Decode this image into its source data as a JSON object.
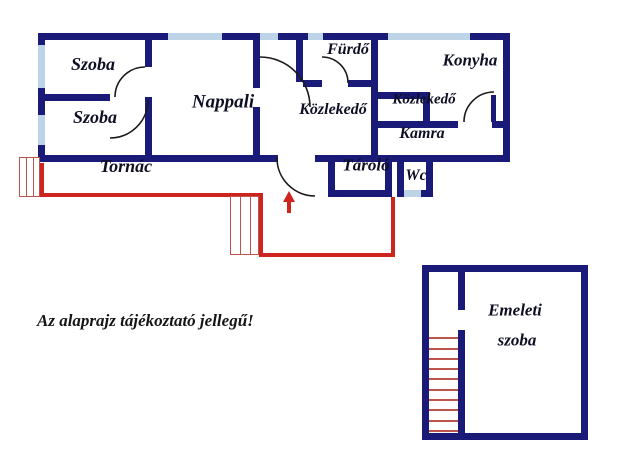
{
  "floorplan": {
    "rooms": {
      "szoba_top": "Szoba",
      "szoba_bottom": "Szoba",
      "nappali": "Nappali",
      "furdo": "Fürdő",
      "konyha": "Konyha",
      "kozlekedo_central": "Közlekedő",
      "kozlekedo_small": "Közlekedő",
      "kamra": "Kamra",
      "tornac": "Tornác",
      "tarolo": "Tároló",
      "wc": "Wc",
      "emeleti_line1": "Emeleti",
      "emeleti_line2": "szoba"
    },
    "note": "Az alaprajz tájékoztató jellegű!",
    "colors": {
      "wall": "#1a1a78",
      "window": "#bdd3e7",
      "porch": "#cd241f",
      "stairs": "#bc564c",
      "door": "#1a1a1a",
      "label": "#0f0f24"
    }
  }
}
